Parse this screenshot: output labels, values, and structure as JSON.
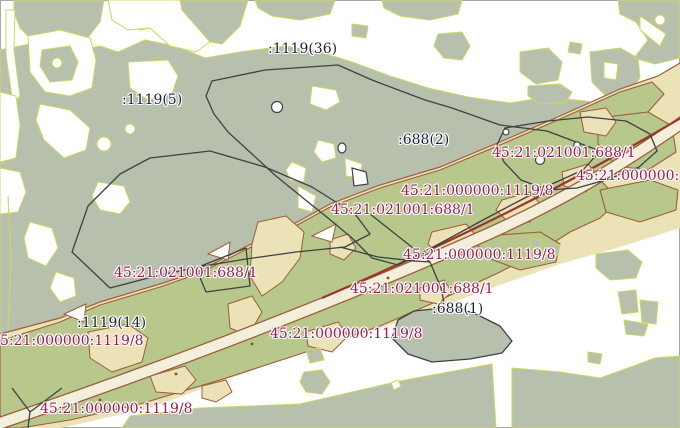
{
  "map": {
    "description": "cadastral map view",
    "labels": [
      {
        "text": ":1119(36)",
        "kind": "dark",
        "x": 268,
        "y": 42
      },
      {
        "text": ":1119(5)",
        "kind": "dark",
        "x": 122,
        "y": 93
      },
      {
        "text": ":688(2)",
        "kind": "dark",
        "x": 398,
        "y": 133
      },
      {
        "text": "45:21:021001:688/1",
        "kind": "red",
        "x": 492,
        "y": 146
      },
      {
        "text": "45:21:000000:1",
        "kind": "red",
        "x": 576,
        "y": 169
      },
      {
        "text": "45:21:000000:1119/8",
        "kind": "red",
        "x": 401,
        "y": 184
      },
      {
        "text": "45:21:021001:688/1",
        "kind": "red",
        "x": 331,
        "y": 203
      },
      {
        "text": "45:21:000000:1119/8",
        "kind": "red",
        "x": 403,
        "y": 248
      },
      {
        "text": "45:21:021001:688/1",
        "kind": "red",
        "x": 114,
        "y": 266
      },
      {
        "text": "45:21:021001:688/1",
        "kind": "red",
        "x": 350,
        "y": 282
      },
      {
        "text": ":688(1)",
        "kind": "dark",
        "x": 432,
        "y": 302
      },
      {
        "text": ":1119(14)",
        "kind": "dark",
        "x": 77,
        "y": 316
      },
      {
        "text": "5:21:000000:1119/8",
        "kind": "red",
        "x": 0,
        "y": 334
      },
      {
        "text": "45:21:000000:1119/8",
        "kind": "red",
        "x": 270,
        "y": 327
      },
      {
        "text": "45:21:000000:1119/8",
        "kind": "red",
        "x": 40,
        "y": 402
      }
    ]
  },
  "colors": {
    "forest": "#b7c0ac",
    "forestStroke": "#ccd75f",
    "band": "#ebe2b8",
    "parcelGreen": "#b8c78c",
    "parcelStroke": "#9c5d39",
    "roadFill": "#f4efda",
    "roadLine": "#9e332c",
    "boundary": "#3c4244",
    "labelRed": "#9d1a4e",
    "labelDark": "#1f2038",
    "background": "#ffffff"
  }
}
